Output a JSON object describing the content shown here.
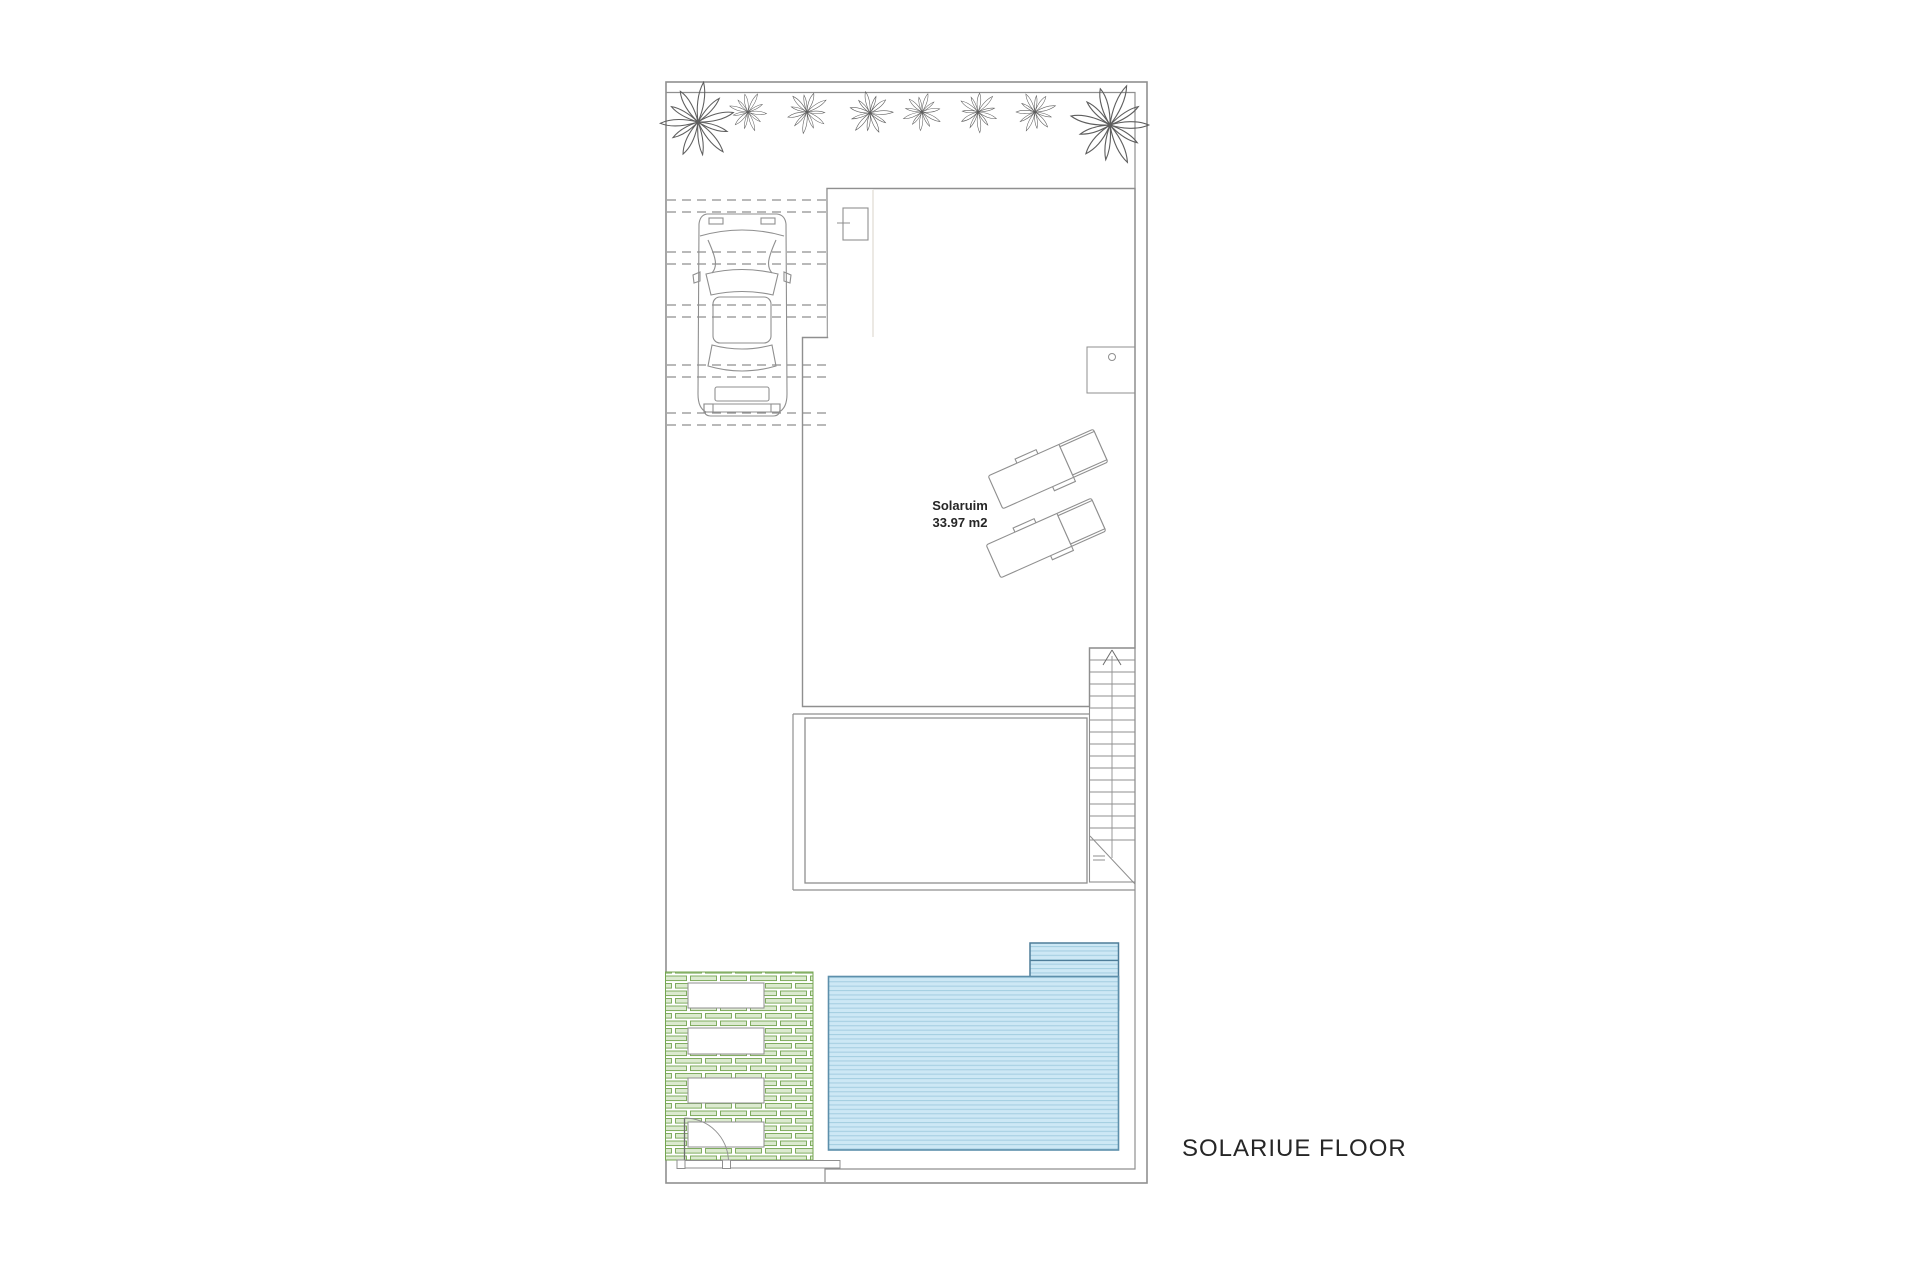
{
  "plan": {
    "floor_title": "SOLARIUE FLOOR",
    "solarium": {
      "name": "Solaruim",
      "area": "33.97 m2"
    }
  },
  "colors": {
    "line": "#8f8f8f",
    "line_dark": "#6e6e6e",
    "wood_bg": "#f0ebe4",
    "wood_streak": "#e2d9cb",
    "wood_streak2": "#e8e1d5",
    "water_bg": "#cde8f5",
    "water_stripe": "#a6cfe2",
    "water_border": "#5d8fab",
    "water_border_dark": "#4e7d99",
    "green_fill": "#dcead0",
    "green_stroke": "#74a551",
    "text": "#262626"
  }
}
